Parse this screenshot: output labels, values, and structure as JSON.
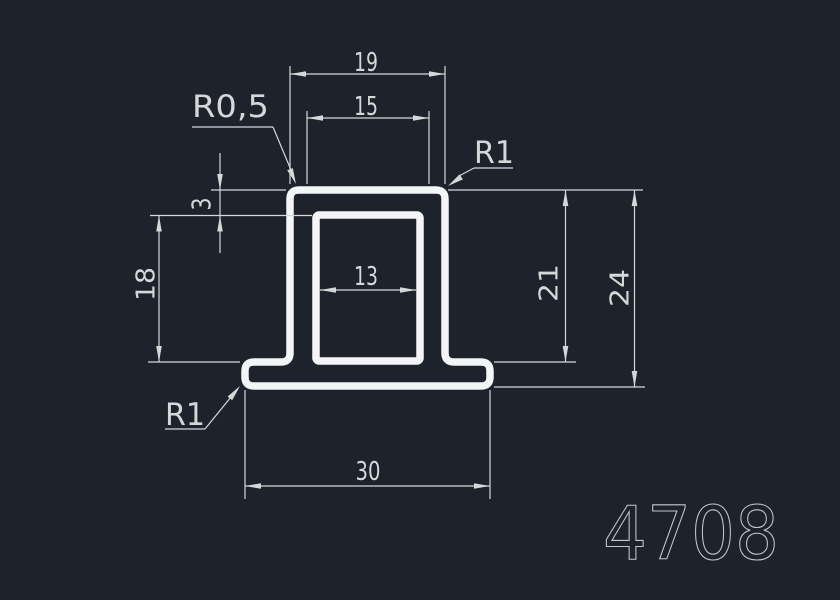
{
  "drawing": {
    "part_number": "4708",
    "dimensions": {
      "top_width": "19",
      "top_flat_width": "15",
      "inner_width": "13",
      "base_width": "30",
      "top_wall_thickness": "3",
      "inner_height": "18",
      "body_height": "21",
      "total_height": "24"
    },
    "radius_labels": {
      "top_left": "R0,5",
      "top_right": "R1",
      "bottom_left": "R1"
    },
    "colors": {
      "background": "#1e222a",
      "profile-line": "#f4f5f7",
      "dimension-line": "#d5d7d9",
      "part-number": "#c3c8cd"
    }
  }
}
